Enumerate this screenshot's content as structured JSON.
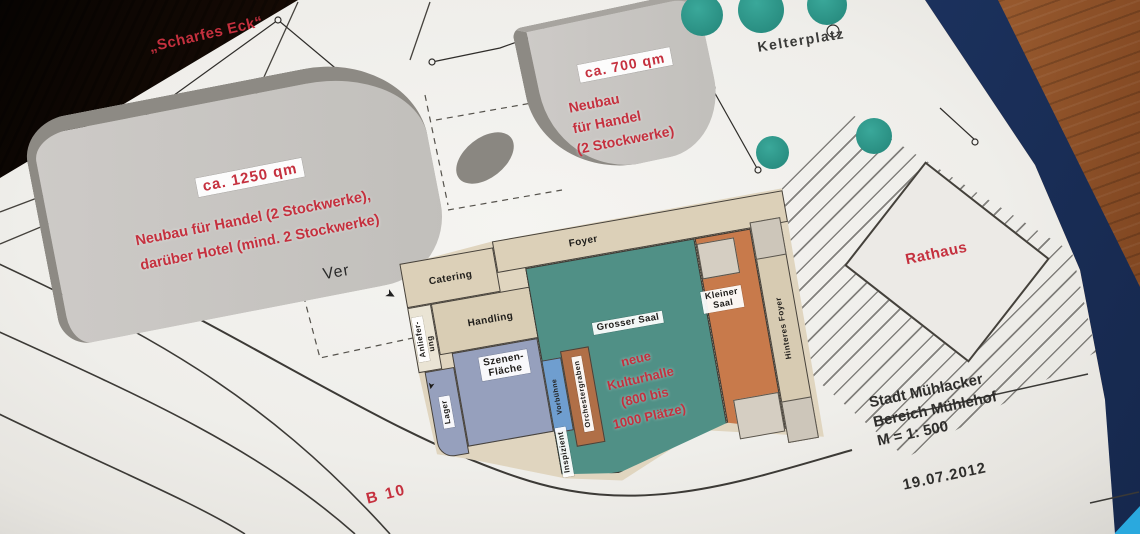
{
  "plan": {
    "areas": {
      "scharfes_eck": "„Scharfes Eck“",
      "blob_1250": {
        "size_label": "ca. 1250 qm",
        "note_line1": "Neubau für Handel (2 Stockwerke),",
        "note_line2": "darüber Hotel (mind. 2 Stockwerke)"
      },
      "blob_700": {
        "size_label": "ca. 700 qm",
        "note_line1": "Neubau",
        "note_line2": "für Handel",
        "note_line3": "(2 Stockwerke)"
      },
      "kelterplatz": "Kelterplatz",
      "rathaus": "Rathaus",
      "b10": "B 10",
      "ver": "Ver"
    },
    "rooms": {
      "foyer": "Foyer",
      "catering": "Catering",
      "handling": "Handling",
      "anlieferung_line1": "Anliefer-",
      "anlieferung_line2": "ung",
      "szenen_line1": "Szenen-",
      "szenen_line2": "Fläche",
      "lager": "Lager",
      "vorbuehne": "Vorbühne",
      "orchestergraben": "Orchestergraben",
      "grosser_saal": "Grosser Saal",
      "kleiner_line1": "Kleiner",
      "kleiner_line2": "Saal",
      "hinteres_foyer": "Hinteres Foyer",
      "inspizient": "Inspizient"
    },
    "hall_note": {
      "line1": "neue",
      "line2": "Kulturhalle",
      "line3": "(800 bis",
      "line4": "1000 Plätze)"
    },
    "titleblock": {
      "line1": "Stadt Mühlacker",
      "line2": "Bereich Mühlehof",
      "line3": "M = 1: 500",
      "date": "19.07.2012"
    }
  },
  "colors": {
    "paper": "#efeeea",
    "wood": "#8a4c24",
    "wood_dark": "#1d0f08",
    "binder_navy": "#1f3a6b",
    "binder_cyan": "#2aa9de",
    "tree_green": "#2d9a8e",
    "hall_teal": "#509086",
    "stage_blue": "#96a0bd",
    "forestage_blue": "#6f9ecf",
    "pit_brown": "#b06f47",
    "saal_orange": "#c87a4b",
    "foyer_beige": "#dcd0b8",
    "building_gray": "#c7c5c2",
    "annotation_red": "#c5303e",
    "line_dark": "#3c3a36"
  }
}
